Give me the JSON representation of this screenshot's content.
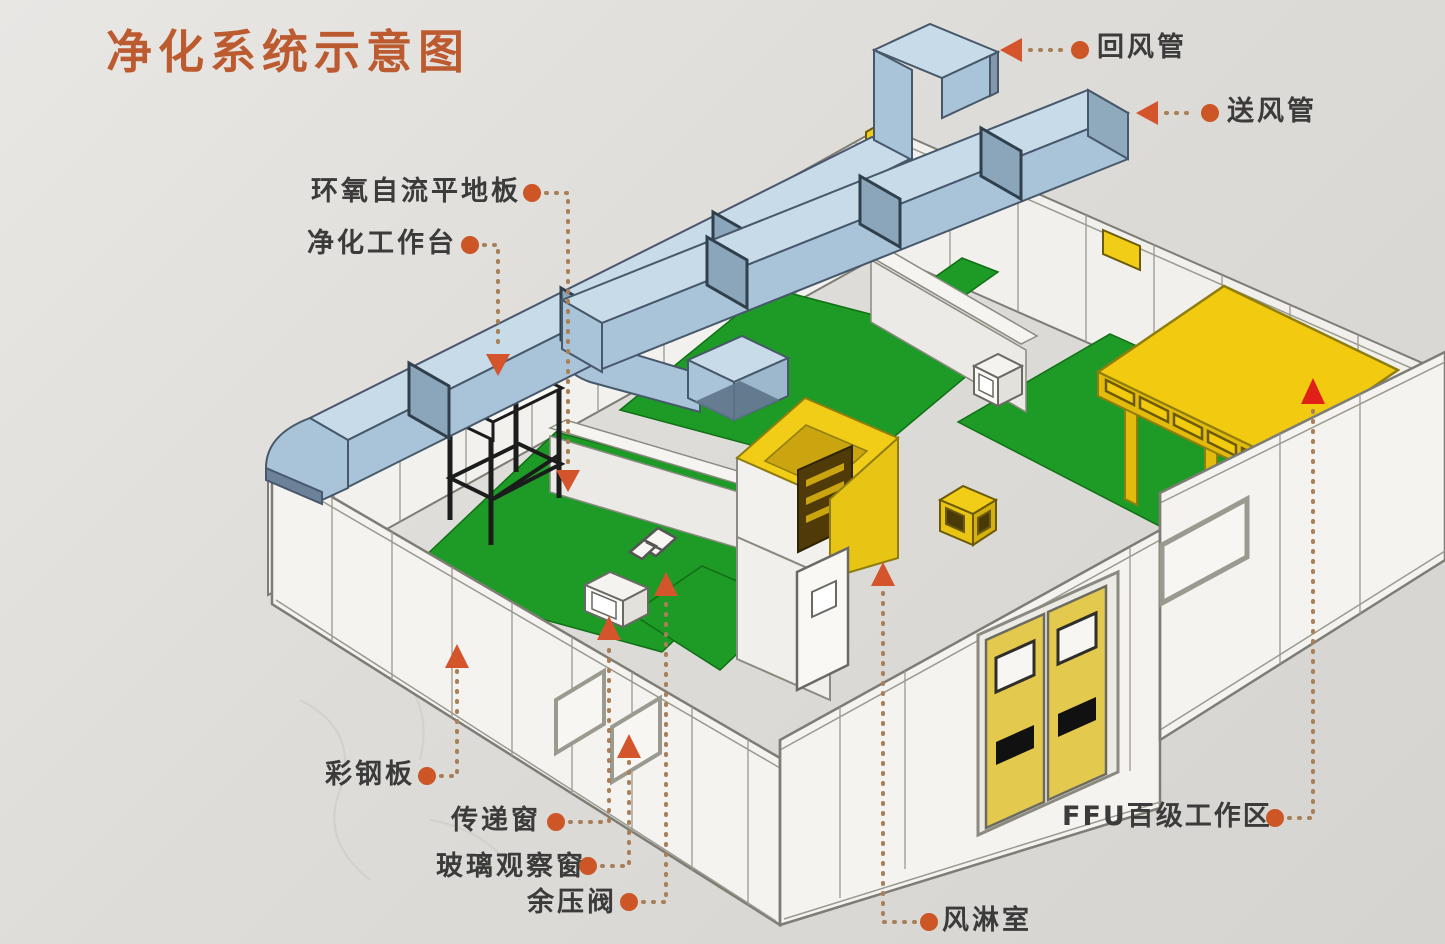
{
  "title": "净化系统示意图",
  "labels": [
    {
      "id": "return-duct",
      "text": "回风管"
    },
    {
      "id": "supply-duct",
      "text": "送风管"
    },
    {
      "id": "epoxy-self-leveling-floor",
      "text": "环氧自流平地板"
    },
    {
      "id": "clean-workbench",
      "text": "净化工作台"
    },
    {
      "id": "color-steel-panel",
      "text": "彩钢板"
    },
    {
      "id": "transfer-window",
      "text": "传递窗"
    },
    {
      "id": "glass-observation-window",
      "text": "玻璃观察窗"
    },
    {
      "id": "residual-pressure-valve",
      "text": "余压阀"
    },
    {
      "id": "air-shower-room",
      "text": "风淋室"
    },
    {
      "id": "ffu-class100-work-area",
      "text": "FFU百级工作区"
    }
  ],
  "colors": {
    "title_text": "#bc5a30",
    "label_text": "#3b3b3b",
    "leader_dot": "#cc5626",
    "leader_arrow": "#d4542b",
    "ffu_arrow": "#df2117",
    "leader_dotted_line": "#a87f56",
    "duct_side": "#a9c4d9",
    "duct_top": "#c8dbe9",
    "floor_green": "#1d9b26",
    "wall_white": "#f3f2ee",
    "ffu_yellow": "#f2cb10",
    "door_yellow": "#e4c94f",
    "background": "#dcdad6"
  }
}
